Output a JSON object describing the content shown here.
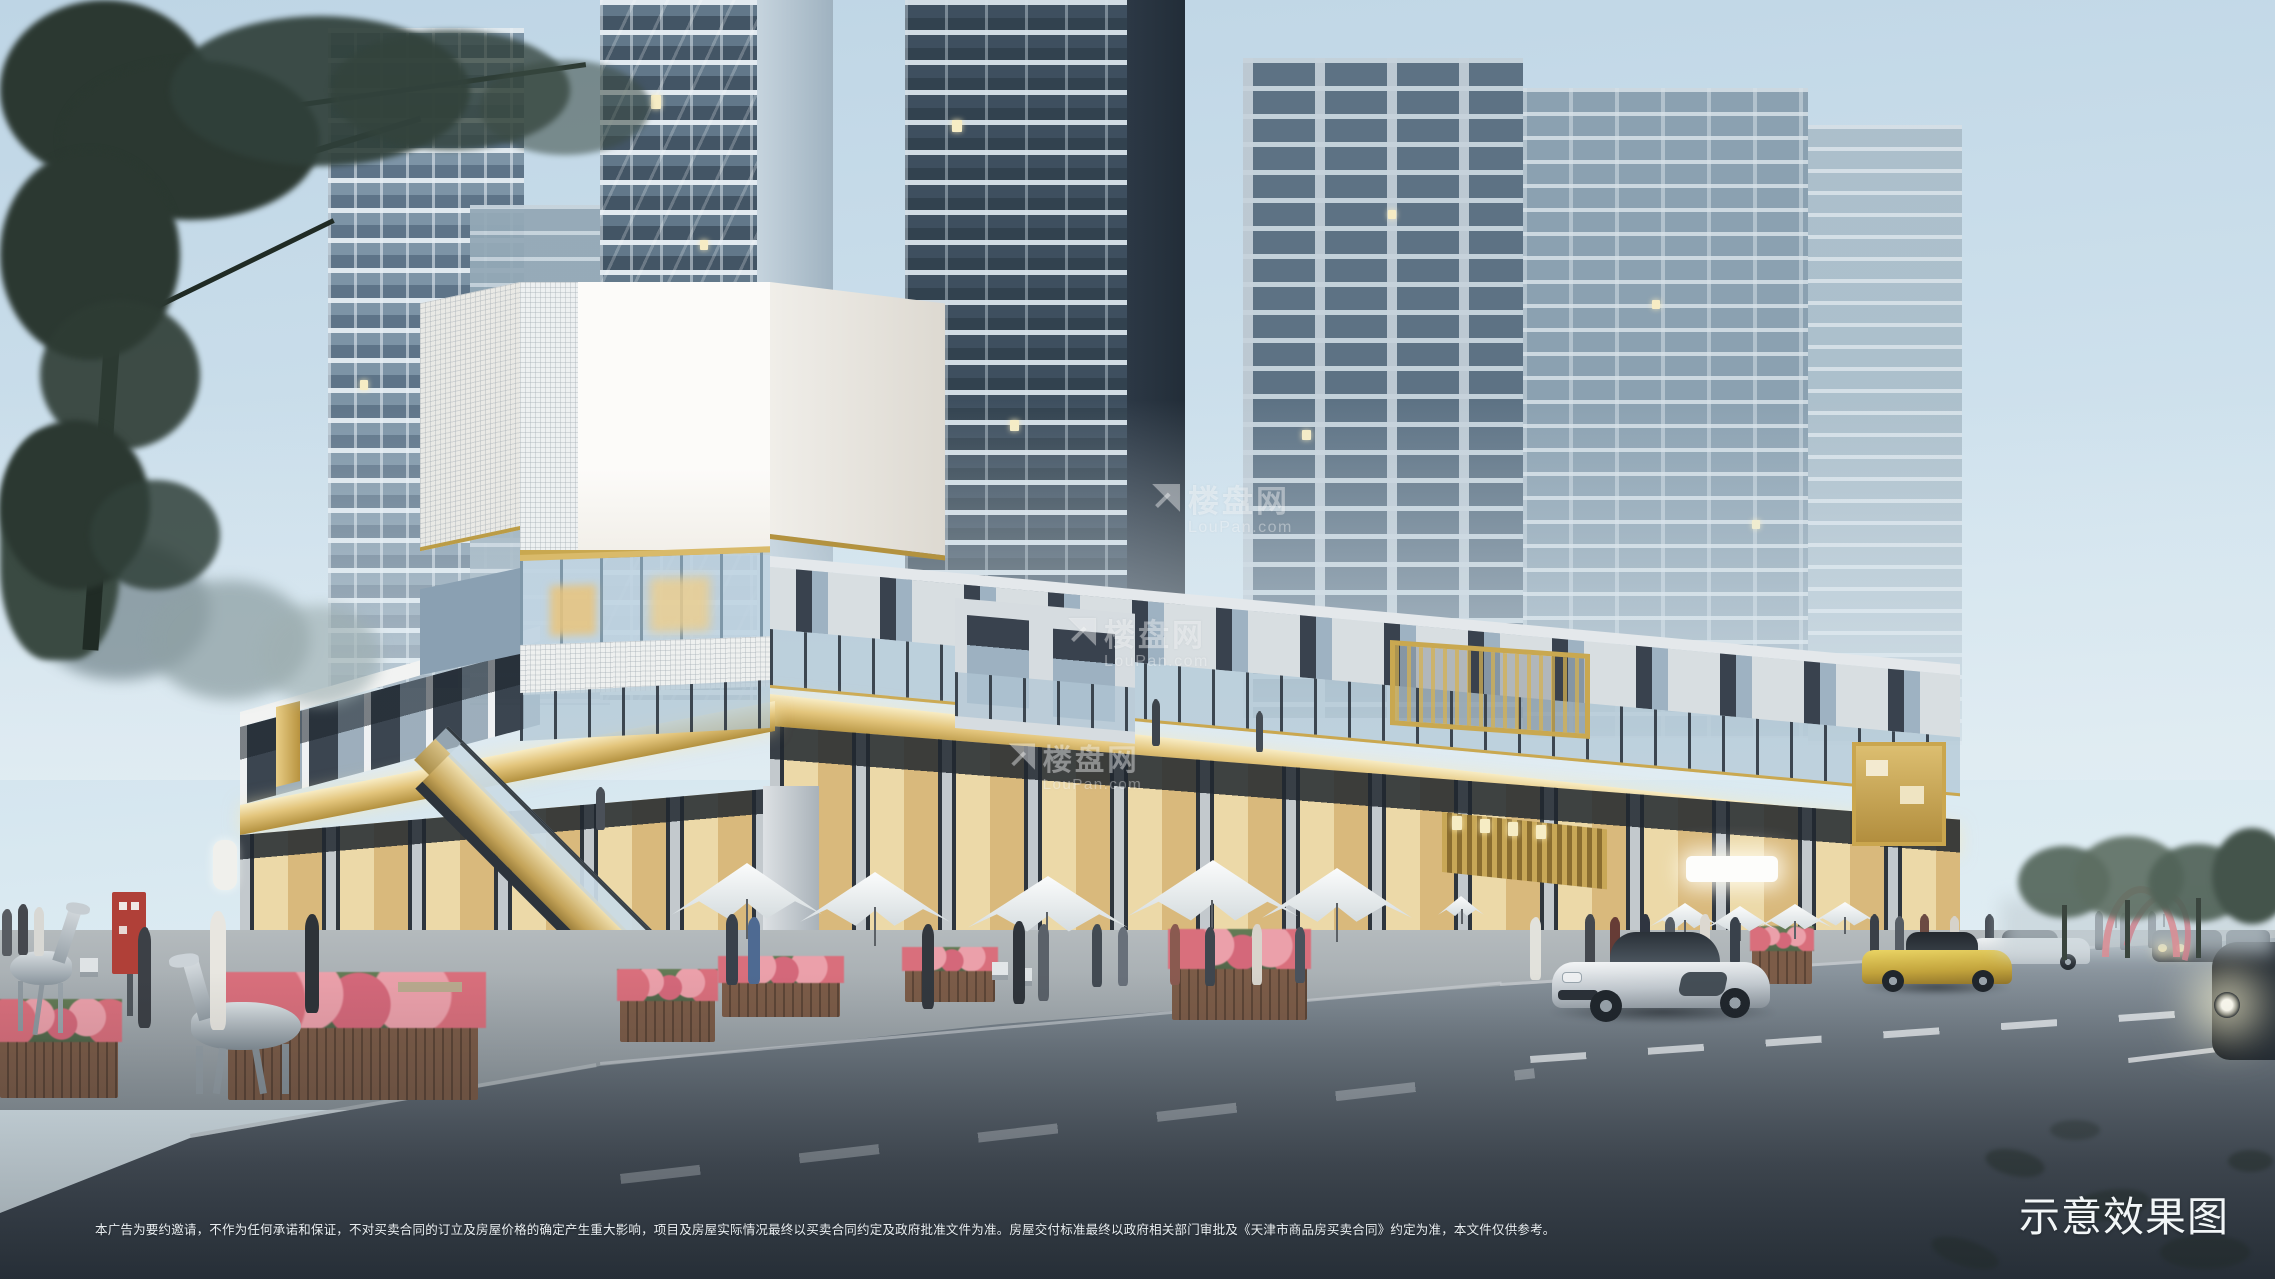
{
  "overlay": {
    "disclaimer": "本广告为要约邀请，不作为任何承诺和保证，不对买卖合同的订立及房屋价格的确定产生重大影响，项目及房屋实际情况最终以买卖合同约定及政府批准文件为准。房屋交付标准最终以政府相关部门审批及《天津市商品房买卖合同》约定为准，本文件仅供参考。",
    "render_label": "示意效果图"
  },
  "watermark": {
    "name": "楼盘网",
    "domain": "LouPan.com"
  },
  "colors": {
    "sky_top": "#bed5e5",
    "sky_horizon": "#e8f1f5",
    "gold": "#c9a850",
    "gold_lit": "#f3e3b0",
    "white_volume": "#f8f6f2",
    "tower_dark": "#3e4f5f",
    "tower_light": "#a9bcc8",
    "asphalt": "#454e57",
    "flower": "#d4687a"
  }
}
